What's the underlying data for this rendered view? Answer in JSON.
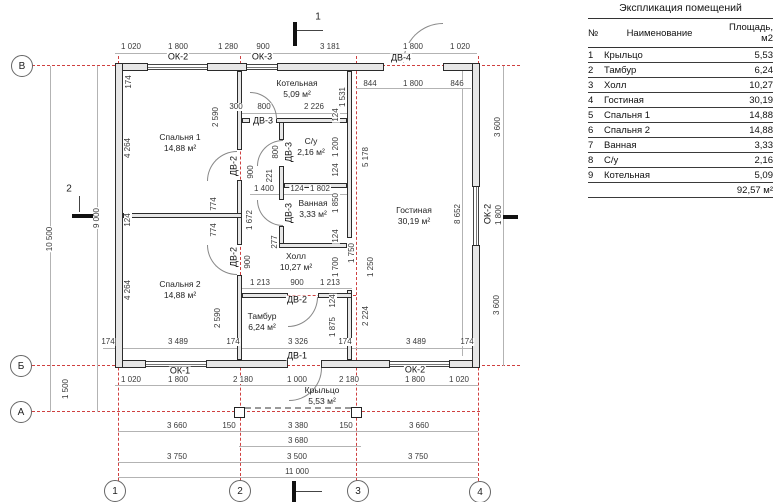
{
  "table": {
    "title": "Экспликация помещений",
    "headers": {
      "num": "№",
      "name": "Наименование",
      "area": "Площадь, м2"
    },
    "rows": [
      [
        "1",
        "Крыльцо",
        "5,53"
      ],
      [
        "2",
        "Тамбур",
        "6,24"
      ],
      [
        "3",
        "Холл",
        "10,27"
      ],
      [
        "4",
        "Гостиная",
        "30,19"
      ],
      [
        "5",
        "Спальня 1",
        "14,88"
      ],
      [
        "6",
        "Спальня 2",
        "14,88"
      ],
      [
        "7",
        "Ванная",
        "3,33"
      ],
      [
        "8",
        "С/у",
        "2,16"
      ],
      [
        "9",
        "Котельная",
        "5,09"
      ]
    ],
    "total": "92,57 м²"
  },
  "plan": {
    "colors": {
      "axis_red": "#cf4040",
      "wall_fill": "#e7e7e7",
      "line_gray": "#b3b3b3"
    },
    "axis_circles": [
      {
        "t": "В",
        "x": 22,
        "y": 66
      },
      {
        "t": "Б",
        "x": 21,
        "y": 366
      },
      {
        "t": "А",
        "x": 21,
        "y": 412
      },
      {
        "t": "1",
        "x": 115,
        "y": 491
      },
      {
        "t": "2",
        "x": 240,
        "y": 491
      },
      {
        "t": "3",
        "x": 358,
        "y": 491
      },
      {
        "t": "4",
        "x": 480,
        "y": 492
      }
    ],
    "section_labels": [
      {
        "t": "1",
        "x": 318,
        "y": 17
      },
      {
        "t": "2",
        "x": 69,
        "y": 189
      }
    ],
    "rooms": [
      {
        "t": "Спальня 1",
        "t2": "14,88 м²",
        "x": 180,
        "y": 143
      },
      {
        "t": "Котельная",
        "t2": "5,09 м²",
        "x": 297,
        "y": 89
      },
      {
        "t": "С/у",
        "t2": "2,16 м²",
        "x": 311,
        "y": 147
      },
      {
        "t": "Ванная",
        "t2": "3,33 м²",
        "x": 313,
        "y": 209
      },
      {
        "t": "Холл",
        "t2": "10,27 м²",
        "x": 296,
        "y": 262
      },
      {
        "t": "Спальня 2",
        "t2": "14,88 м²",
        "x": 180,
        "y": 290
      },
      {
        "t": "Тамбур",
        "t2": "6,24 м²",
        "x": 262,
        "y": 322
      },
      {
        "t": "Гостиная",
        "t2": "30,19 м²",
        "x": 414,
        "y": 216
      },
      {
        "t": "Крыльцо",
        "t2": "5,53 м²",
        "x": 322,
        "y": 396
      }
    ],
    "opening_labels": [
      {
        "t": "ОК-2",
        "x": 178,
        "y": 57
      },
      {
        "t": "ОК-3",
        "x": 262,
        "y": 57
      },
      {
        "t": "ДВ-4",
        "x": 401,
        "y": 58
      },
      {
        "t": "ОК-1",
        "x": 180,
        "y": 371
      },
      {
        "t": "ОК-2",
        "x": 415,
        "y": 370
      },
      {
        "t": "ОК-2",
        "x": 488,
        "y": 214,
        "rot": true
      },
      {
        "t": "ДВ-1",
        "x": 297,
        "y": 356
      },
      {
        "t": "ДВ-2",
        "x": 297,
        "y": 300
      },
      {
        "t": "ДВ-2",
        "x": 234,
        "y": 166,
        "rot": true
      },
      {
        "t": "ДВ-2",
        "x": 234,
        "y": 257,
        "rot": true
      },
      {
        "t": "ДВ-3",
        "x": 263,
        "y": 121
      },
      {
        "t": "ДВ-3",
        "x": 289,
        "y": 152,
        "rot": true
      },
      {
        "t": "ДВ-3",
        "x": 289,
        "y": 213,
        "rot": true
      }
    ],
    "dim_labels": [
      {
        "t": "1 020",
        "x": 131,
        "y": 47
      },
      {
        "t": "1 800",
        "x": 178,
        "y": 47
      },
      {
        "t": "1 280",
        "x": 228,
        "y": 47
      },
      {
        "t": "900",
        "x": 263,
        "y": 47
      },
      {
        "t": "3 181",
        "x": 330,
        "y": 47
      },
      {
        "t": "1 800",
        "x": 413,
        "y": 47
      },
      {
        "t": "1 020",
        "x": 460,
        "y": 47
      },
      {
        "t": "844",
        "x": 370,
        "y": 84
      },
      {
        "t": "1 800",
        "x": 413,
        "y": 84
      },
      {
        "t": "846",
        "x": 457,
        "y": 84
      },
      {
        "t": "174",
        "x": 129,
        "y": 82,
        "rot": true
      },
      {
        "t": "4 264",
        "x": 128,
        "y": 148,
        "rot": true
      },
      {
        "t": "124",
        "x": 128,
        "y": 220,
        "rot": true
      },
      {
        "t": "4 264",
        "x": 128,
        "y": 290,
        "rot": true
      },
      {
        "t": "10 500",
        "x": 50,
        "y": 239,
        "rot": true
      },
      {
        "t": "9 000",
        "x": 97,
        "y": 218,
        "rot": true
      },
      {
        "t": "1 500",
        "x": 66,
        "y": 389,
        "rot": true
      },
      {
        "t": "174",
        "x": 108,
        "y": 342
      },
      {
        "t": "3 489",
        "x": 178,
        "y": 342
      },
      {
        "t": "174",
        "x": 233,
        "y": 342
      },
      {
        "t": "3 326",
        "x": 298,
        "y": 342
      },
      {
        "t": "174",
        "x": 345,
        "y": 342
      },
      {
        "t": "3 489",
        "x": 416,
        "y": 342
      },
      {
        "t": "174",
        "x": 467,
        "y": 342
      },
      {
        "t": "1 020",
        "x": 131,
        "y": 380
      },
      {
        "t": "1 800",
        "x": 178,
        "y": 380
      },
      {
        "t": "2 180",
        "x": 243,
        "y": 380
      },
      {
        "t": "1 000",
        "x": 297,
        "y": 380
      },
      {
        "t": "2 180",
        "x": 349,
        "y": 380
      },
      {
        "t": "1 800",
        "x": 415,
        "y": 380
      },
      {
        "t": "1 020",
        "x": 459,
        "y": 380
      },
      {
        "t": "3 660",
        "x": 177,
        "y": 426
      },
      {
        "t": "150",
        "x": 229,
        "y": 426
      },
      {
        "t": "3 380",
        "x": 298,
        "y": 426
      },
      {
        "t": "150",
        "x": 346,
        "y": 426
      },
      {
        "t": "3 660",
        "x": 419,
        "y": 426
      },
      {
        "t": "3 680",
        "x": 298,
        "y": 441
      },
      {
        "t": "3 750",
        "x": 177,
        "y": 457
      },
      {
        "t": "3 500",
        "x": 297,
        "y": 457
      },
      {
        "t": "3 750",
        "x": 418,
        "y": 457
      },
      {
        "t": "11 000",
        "x": 297,
        "y": 472
      },
      {
        "t": "8 652",
        "x": 458,
        "y": 214,
        "rot": true
      },
      {
        "t": "3 600",
        "x": 498,
        "y": 127,
        "rot": true
      },
      {
        "t": "1 800",
        "x": 499,
        "y": 215,
        "rot": true
      },
      {
        "t": "3 600",
        "x": 497,
        "y": 305,
        "rot": true
      },
      {
        "t": "300",
        "x": 236,
        "y": 107
      },
      {
        "t": "800",
        "x": 264,
        "y": 107
      },
      {
        "t": "2 226",
        "x": 314,
        "y": 107
      },
      {
        "t": "1 531",
        "x": 343,
        "y": 97,
        "rot": true
      },
      {
        "t": "124",
        "x": 336,
        "y": 115,
        "rot": true
      },
      {
        "t": "2 590",
        "x": 216,
        "y": 117,
        "rot": true
      },
      {
        "t": "900",
        "x": 251,
        "y": 172,
        "rot": true
      },
      {
        "t": "800",
        "x": 276,
        "y": 152,
        "rot": true
      },
      {
        "t": "1 200",
        "x": 336,
        "y": 147,
        "rot": true
      },
      {
        "t": "5 178",
        "x": 366,
        "y": 157,
        "rot": true
      },
      {
        "t": "1 221",
        "x": 270,
        "y": 179,
        "rot": true
      },
      {
        "t": "1 400",
        "x": 264,
        "y": 189
      },
      {
        "t": "124",
        "x": 297,
        "y": 189
      },
      {
        "t": "1 802",
        "x": 320,
        "y": 189
      },
      {
        "t": "774",
        "x": 214,
        "y": 204,
        "rot": true
      },
      {
        "t": "774",
        "x": 214,
        "y": 230,
        "rot": true
      },
      {
        "t": "1 672",
        "x": 250,
        "y": 220,
        "rot": true
      },
      {
        "t": "900",
        "x": 248,
        "y": 262,
        "rot": true
      },
      {
        "t": "2 590",
        "x": 218,
        "y": 318,
        "rot": true
      },
      {
        "t": "124",
        "x": 336,
        "y": 170,
        "rot": true
      },
      {
        "t": "1 850",
        "x": 336,
        "y": 203,
        "rot": true
      },
      {
        "t": "124",
        "x": 336,
        "y": 236,
        "rot": true
      },
      {
        "t": "277",
        "x": 275,
        "y": 242,
        "rot": true
      },
      {
        "t": "1 700",
        "x": 336,
        "y": 267,
        "rot": true
      },
      {
        "t": "1 250",
        "x": 371,
        "y": 267,
        "rot": true
      },
      {
        "t": "1 750",
        "x": 352,
        "y": 253,
        "rot": true
      },
      {
        "t": "124",
        "x": 333,
        "y": 301,
        "rot": true
      },
      {
        "t": "1 875",
        "x": 333,
        "y": 327,
        "rot": true
      },
      {
        "t": "2 224",
        "x": 366,
        "y": 316,
        "rot": true
      },
      {
        "t": "1 213",
        "x": 260,
        "y": 283
      },
      {
        "t": "900",
        "x": 297,
        "y": 283
      },
      {
        "t": "1 213",
        "x": 330,
        "y": 283
      }
    ]
  }
}
